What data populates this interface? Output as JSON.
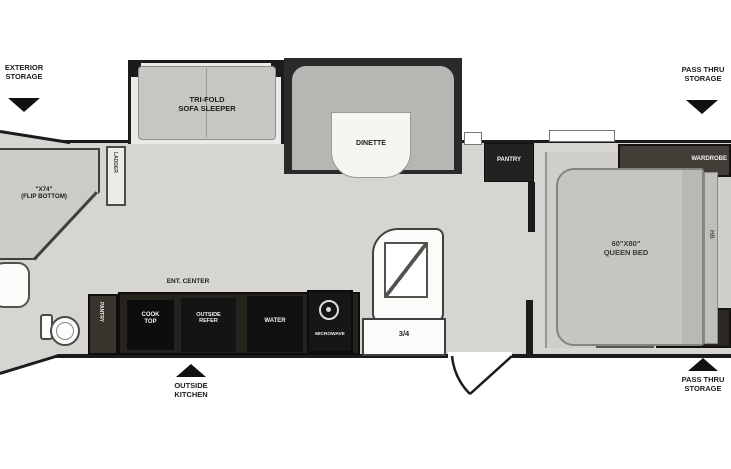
{
  "floorplan": {
    "title": "travel-trailer-floor-plan",
    "outside": {
      "exterior_storage_1": "EXTERIOR",
      "exterior_storage_2": "STORAGE",
      "pass_thru_top_1": "PASS THRU",
      "pass_thru_top_2": "STORAGE",
      "pass_thru_bottom_1": "PASS THRU",
      "pass_thru_bottom_2": "STORAGE",
      "outside_kitchen_1": "OUTSIDE",
      "outside_kitchen_2": "KITCHEN"
    },
    "interior": {
      "bunk_size": "\"X74\"",
      "bunk_note": "(FLIP BOTTOM)",
      "ladder": "LADDER",
      "sofa_1": "TRI-FOLD",
      "sofa_2": "SOFA SLEEPER",
      "dinette": "DINETTE",
      "pantry": "PANTRY",
      "pantry_cabinet": "PANTRY",
      "ent_center": "ENT. CENTER",
      "cook_top_1": "COOK",
      "cook_top_2": "TOP",
      "outside_refer_1": "OUTSIDE",
      "outside_refer_2": "REFER",
      "water": "WATER",
      "microwave": "MICROWAVE",
      "bath": "3/4",
      "bed_size": "60\"X80\"",
      "bed_name": "QUEEN BED",
      "headboard": "HB",
      "wardrobe_top": "WARDROBE",
      "wardrobe_bottom": "WARDROBE"
    },
    "colors": {
      "wall": "#1b1b1b",
      "floor": "#d6d5d1",
      "dark_cabinet": "#1d1b19",
      "fixture_white": "#fbfbf9",
      "furniture_gray": "#c7c6c2"
    }
  }
}
